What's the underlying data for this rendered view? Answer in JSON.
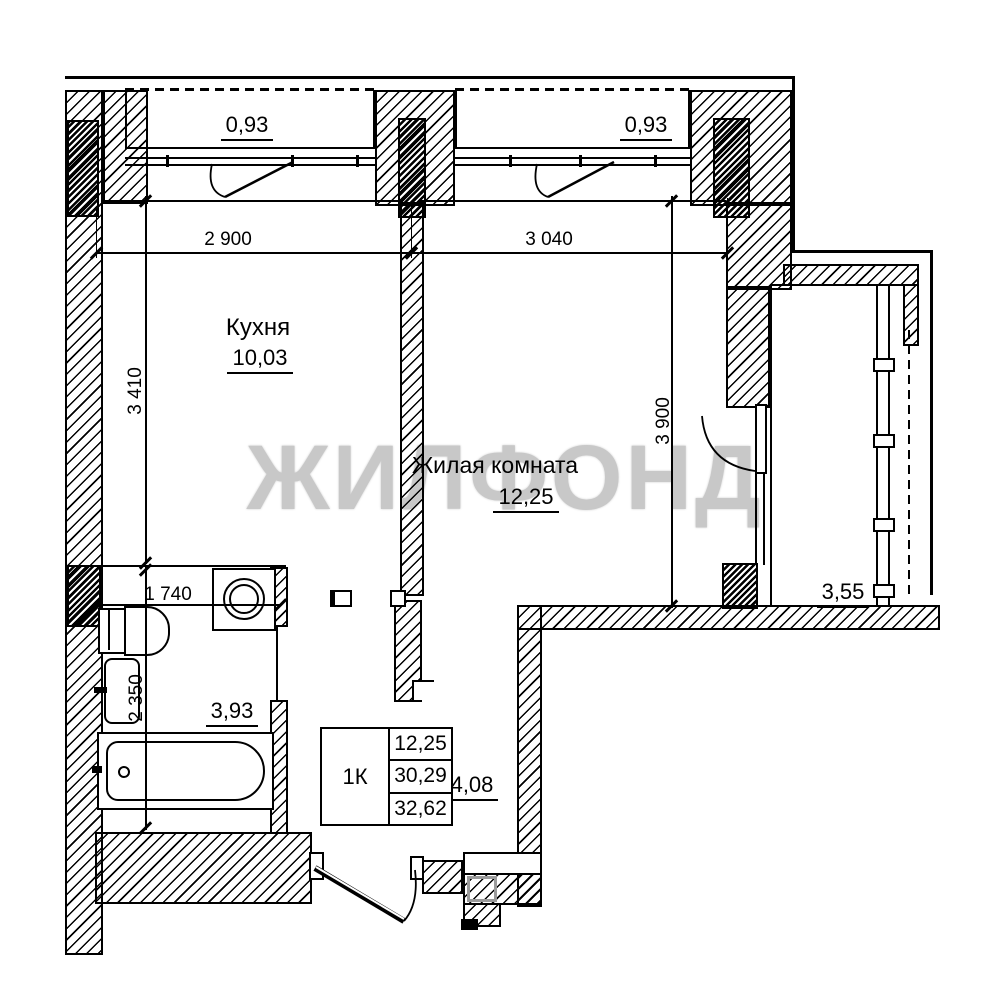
{
  "watermark": "ЖИЛФОНД",
  "rooms": {
    "kitchen": {
      "name": "Кухня",
      "area": "10,03"
    },
    "living": {
      "name": "Жилая комната",
      "area": "12,25"
    }
  },
  "balconies": {
    "top_left_area": "0,93",
    "top_right_area": "0,93",
    "right_area": "3,55"
  },
  "bathroom": {
    "area": "3,93"
  },
  "hallway": {
    "area": "4,08"
  },
  "dimensions": {
    "kitchen_width": "2 900",
    "living_width": "3 040",
    "kitchen_depth": "3 410",
    "living_depth": "3 900",
    "bathroom_width": "1 740",
    "bathroom_depth": "2 350"
  },
  "apartment_table": {
    "type": "1К",
    "living_area": "12,25",
    "area_no_balcony": "30,29",
    "total_area": "32,62"
  }
}
